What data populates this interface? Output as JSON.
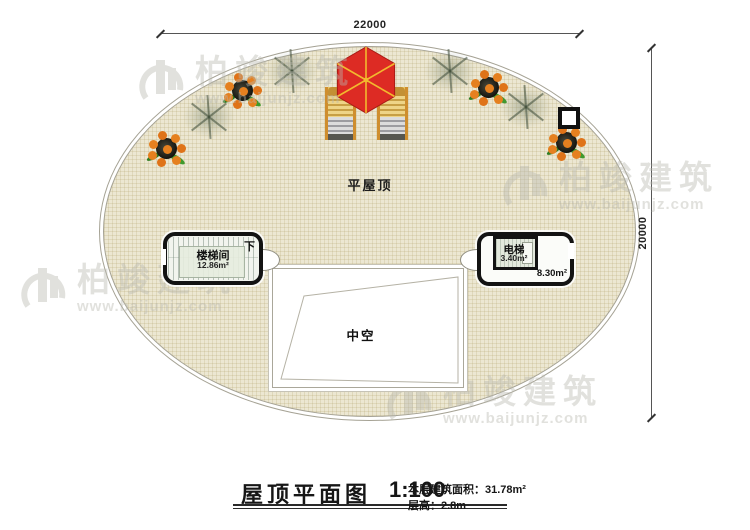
{
  "dimensions": {
    "top": "22000",
    "right": "20000"
  },
  "roof": {
    "label": "平屋顶"
  },
  "stair_room": {
    "name": "楼梯间",
    "area": "12.86m²",
    "direction": "下"
  },
  "elevator": {
    "name": "电梯",
    "shaft_area": "3.40m²",
    "room_area": "8.30m²"
  },
  "void": {
    "label": "中空"
  },
  "title": {
    "name": "屋顶平面图",
    "scale": "1:100",
    "floor_area": "本层建筑面积：31.78m²",
    "floor_height": "层高：2.8m"
  },
  "watermark": {
    "brand": "柏竣建筑",
    "url": "www.baijunjz.com"
  },
  "decorations": {
    "potted_plants": 4,
    "shrubs": 4,
    "lounge_chairs": 2,
    "parasols": 1,
    "roof_vents": 1
  },
  "colors": {
    "roof_fill": "#ece7d2",
    "roof_grid": "#cfc49a",
    "wall": "#131313",
    "parasol_red": "#dd2b24",
    "parasol_rib": "#f2b92e",
    "fruit_orange": "#e5801f",
    "leaf_green": "#3f9a2d",
    "chair_frame": "#cf8e2e",
    "watermark_gray": "#b9b9b0"
  }
}
